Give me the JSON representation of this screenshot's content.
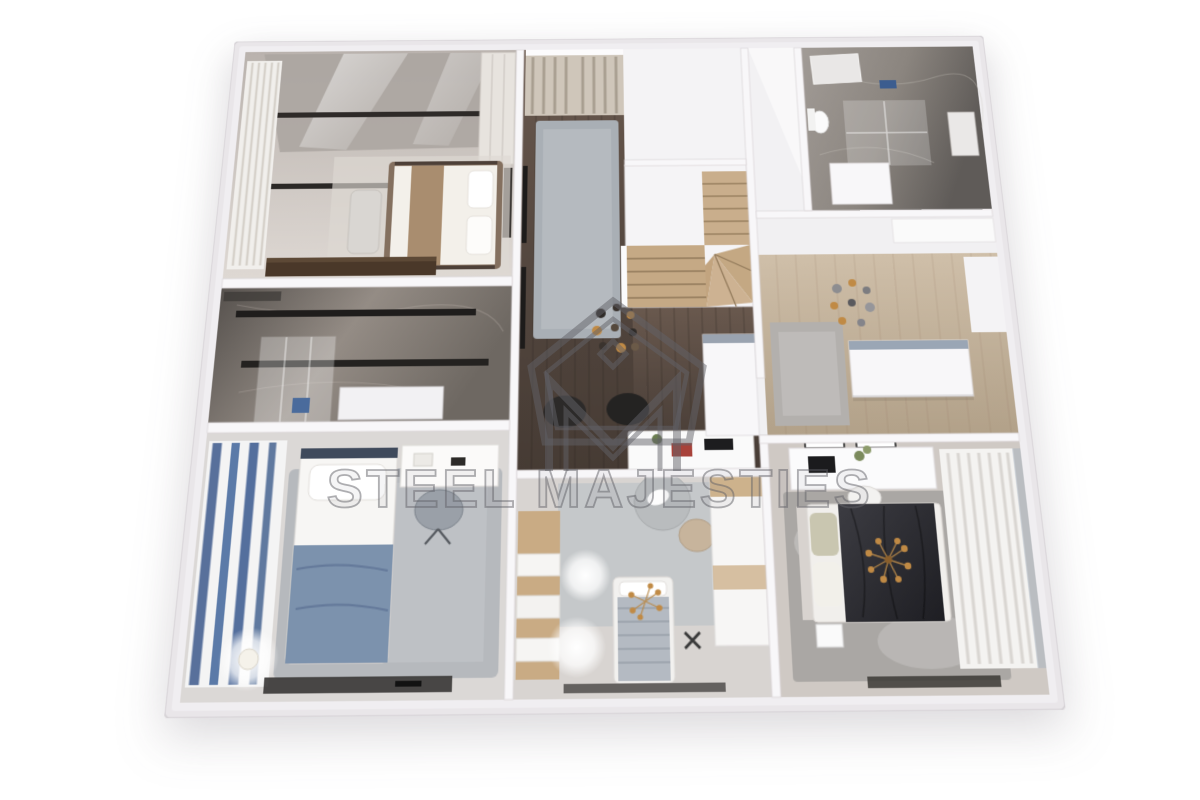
{
  "watermark": {
    "text": "STEEL MAJESTIES",
    "logo_letter": "M"
  },
  "palette": {
    "background": "#ffffff",
    "outer_wall": "#e9e6e9",
    "inner_wall": "#f8f7f9",
    "walnut_floor": "#554840",
    "oak_floor": "#c3b19b",
    "marble_closet": "#847d77",
    "marble_bath": "#8d8781",
    "rug_grey": "#b6b9bd",
    "accent_blue": "#4a6b9c",
    "gold": "#c08a45",
    "duvet_dark": "#2d2d32",
    "duvet_blue": "#7c92ad",
    "stair_wood": "#c9ae8c",
    "watermark": "rgba(98,98,103,0.5)"
  },
  "scene": {
    "type": "3d-floor-plan-render",
    "view": "top-down dollhouse perspective",
    "rooms": [
      {
        "name": "master-bedroom",
        "position": "top-left",
        "items": [
          "double-bed",
          "bench",
          "white-curtains",
          "ceiling-beams",
          "dark-dresser",
          "wardrobe",
          "glass-panels"
        ]
      },
      {
        "name": "walk-in-closet",
        "position": "mid-left",
        "items": [
          "clothes-rails",
          "glass-partition",
          "white-cabinet",
          "blue-box",
          "dark-marble-floor"
        ]
      },
      {
        "name": "kids-bedroom",
        "position": "bottom-left",
        "items": [
          "single-bed",
          "blue-duvet",
          "desk",
          "desk-chair",
          "grey-rug",
          "striped-curtains",
          "glowing-lamp",
          "media-console"
        ]
      },
      {
        "name": "hallway",
        "position": "center",
        "items": [
          "window-curtains",
          "runner-rug",
          "pendant-light-cluster",
          "wall-frames",
          "desk",
          "office-chairs",
          "walnut-floor"
        ]
      },
      {
        "name": "staircase",
        "position": "center-right",
        "items": [
          "winder-stairs",
          "white-balustrade"
        ]
      },
      {
        "name": "bathroom",
        "position": "top-right",
        "items": [
          "glass-shower",
          "toilet",
          "skylight",
          "blue-towel",
          "grey-marble"
        ]
      },
      {
        "name": "dining-area",
        "position": "mid-right",
        "items": [
          "pendant-light-cluster",
          "grey-rug",
          "white-island-wall",
          "oak-floor"
        ]
      },
      {
        "name": "bedroom-2",
        "position": "bottom-right",
        "items": [
          "double-bed",
          "dark-duvet",
          "sputnik-chandelier",
          "vanity-desk",
          "wall-art",
          "white-curtains",
          "mottled-rug"
        ]
      },
      {
        "name": "nursery",
        "position": "bottom-center",
        "items": [
          "toddler-bed",
          "knit-blanket",
          "round-rug",
          "plush-toy",
          "wood-wardrobe",
          "pouf",
          "chandelier",
          "side-desk"
        ]
      }
    ]
  }
}
